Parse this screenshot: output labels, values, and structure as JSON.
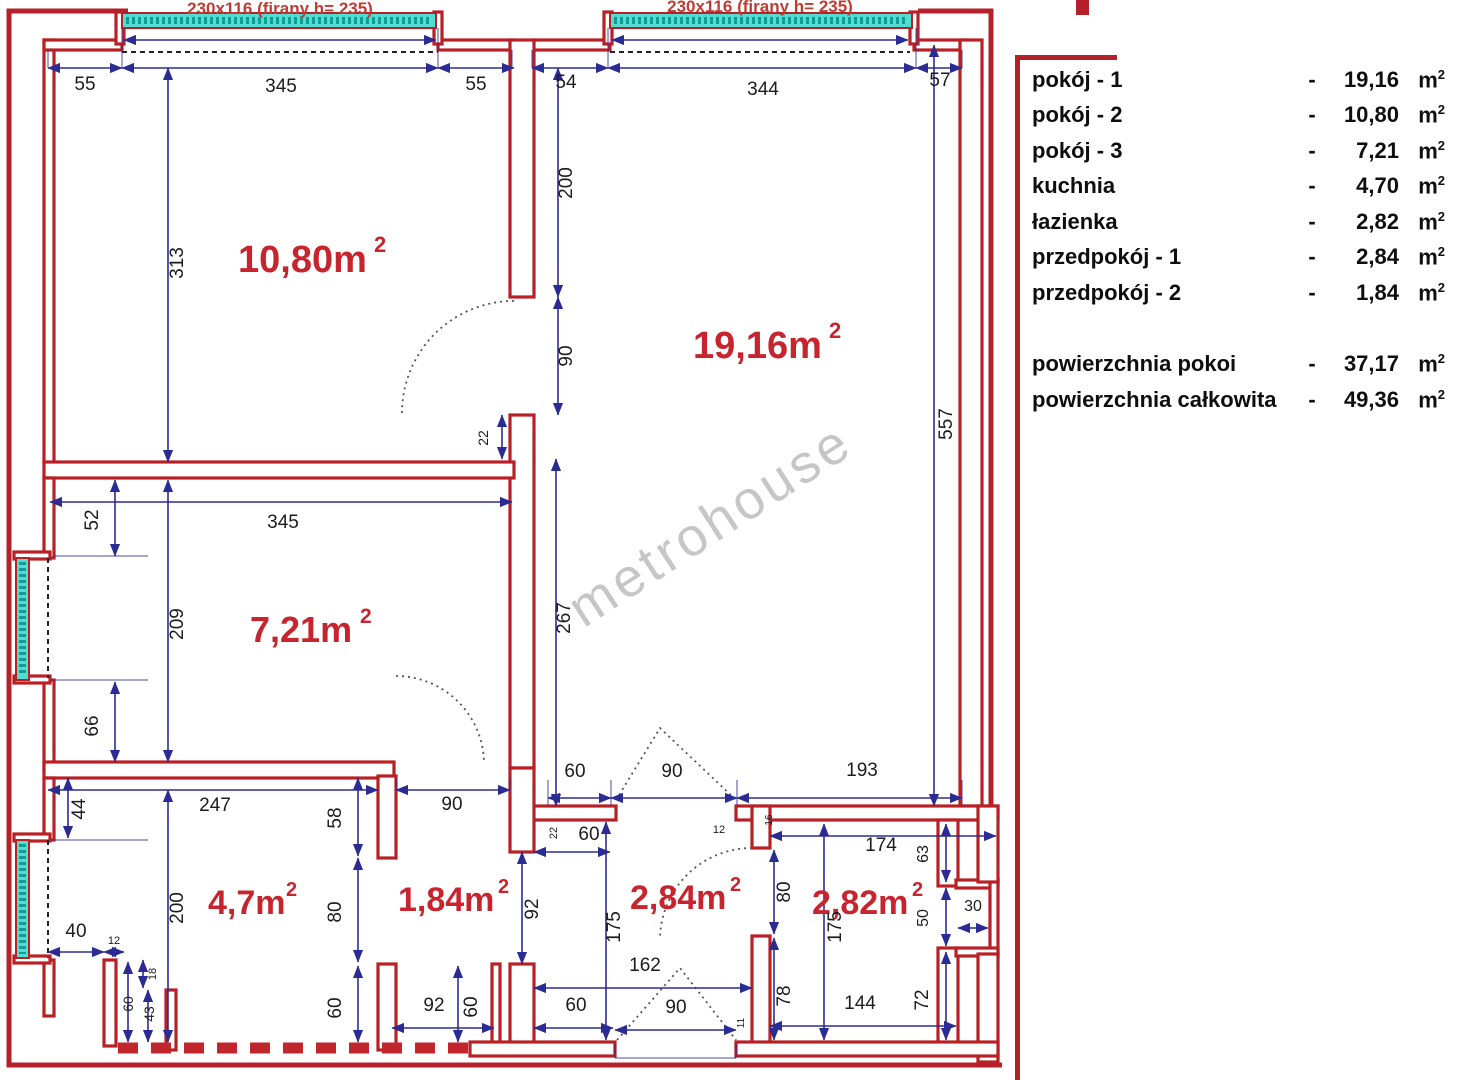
{
  "legend": {
    "rows": [
      {
        "label": "pokój - 1",
        "dash": "-",
        "value": "19,16",
        "unit": "m",
        "sup": "2"
      },
      {
        "label": "pokój - 2",
        "dash": "-",
        "value": "10,80",
        "unit": "m",
        "sup": "2"
      },
      {
        "label": "pokój - 3",
        "dash": "-",
        "value": "7,21",
        "unit": "m",
        "sup": "2"
      },
      {
        "label": "kuchnia",
        "dash": "-",
        "value": "4,70",
        "unit": "m",
        "sup": "2"
      },
      {
        "label": "łazienka",
        "dash": "-",
        "value": "2,82",
        "unit": "m",
        "sup": "2"
      },
      {
        "label": "przedpokój - 1",
        "dash": "-",
        "value": "2,84",
        "unit": "m",
        "sup": "2"
      },
      {
        "label": "przedpokój - 2",
        "dash": "-",
        "value": "1,84",
        "unit": "m",
        "sup": "2"
      }
    ],
    "totals": [
      {
        "label": "powierzchnia pokoi",
        "dash": "-",
        "value": "37,17",
        "unit": "m",
        "sup": "2"
      },
      {
        "label": "powierzchnia całkowita",
        "dash": "-",
        "value": "49,36",
        "unit": "m",
        "sup": "2"
      }
    ]
  },
  "plan": {
    "watermark": "metrohouse",
    "window_labels": {
      "left": "230x116 (firany h= 235)",
      "right": "230x116 (firany h= 235)"
    },
    "rooms": [
      {
        "area": "10,80m",
        "sup": "2"
      },
      {
        "area": "19,16m",
        "sup": "2"
      },
      {
        "area": "7,21m",
        "sup": "2"
      },
      {
        "area": "4,7m",
        "sup": "2"
      },
      {
        "area": "1,84m",
        "sup": "2"
      },
      {
        "area": "2,84m",
        "sup": "2"
      },
      {
        "area": "2,82m",
        "sup": "2"
      }
    ],
    "dims": [
      "55",
      "345",
      "55",
      "54",
      "344",
      "57",
      "313",
      "200",
      "90",
      "22",
      "557",
      "267",
      "60",
      "90",
      "193",
      "52",
      "345",
      "209",
      "66",
      "44",
      "247",
      "58",
      "200",
      "80",
      "60",
      "40",
      "12",
      "18",
      "60",
      "43",
      "90",
      "60",
      "22",
      "92",
      "92",
      "60",
      "60",
      "175",
      "162",
      "90",
      "11",
      "16",
      "12",
      "174",
      "63",
      "50",
      "30",
      "80",
      "175",
      "78",
      "144",
      "72"
    ]
  }
}
